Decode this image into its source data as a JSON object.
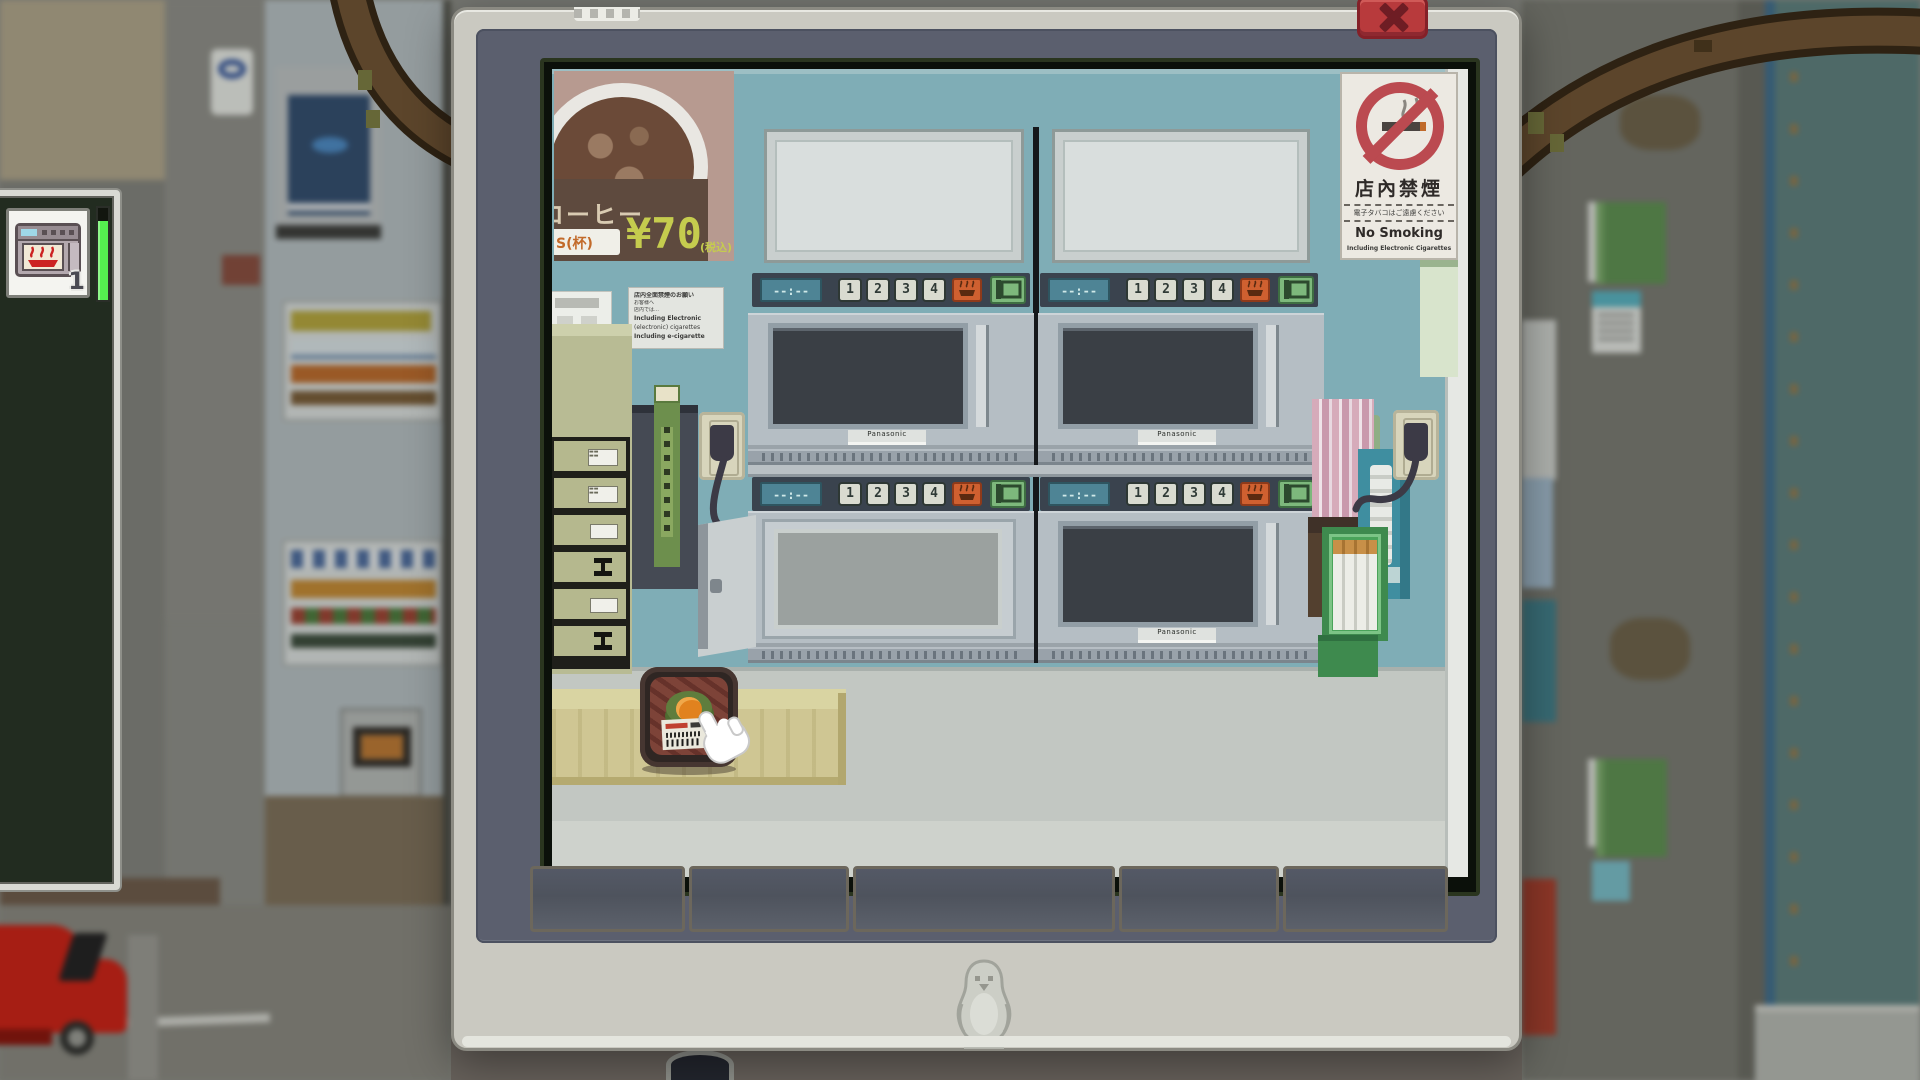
{
  "window": {
    "close_label": "X"
  },
  "inventory": {
    "item_count": "1",
    "item_name": "microwave-item",
    "progress_color": "#55ef4f"
  },
  "scene": {
    "coffee_poster": {
      "title": "コーヒー",
      "size_label": "S(杯)",
      "price": "¥70",
      "tax_note": "(税込)"
    },
    "no_smoking_sign": {
      "title": "店內禁煙",
      "subtitle": "電子タバコはご遠慮ください",
      "en_title": "No Smoking",
      "en_subtitle": "Including Electronic Cigarettes"
    },
    "notice_poster": {
      "lines": [
        "店内全面禁煙のお願い",
        "お客様へ",
        "店内では…",
        "Including Electronic",
        "(electronic) cigarettes",
        "Including e-cigarette"
      ]
    },
    "microwave": {
      "brand": "Panasonic",
      "display": "--:--",
      "keys": [
        "1",
        "2",
        "3",
        "4"
      ]
    }
  },
  "colors": {
    "wall_teal": "#7fadb6",
    "close_red": "#b83a3c",
    "key_orange": "#cf6030",
    "key_green": "#7db87c",
    "progress_green": "#55ef4f"
  }
}
